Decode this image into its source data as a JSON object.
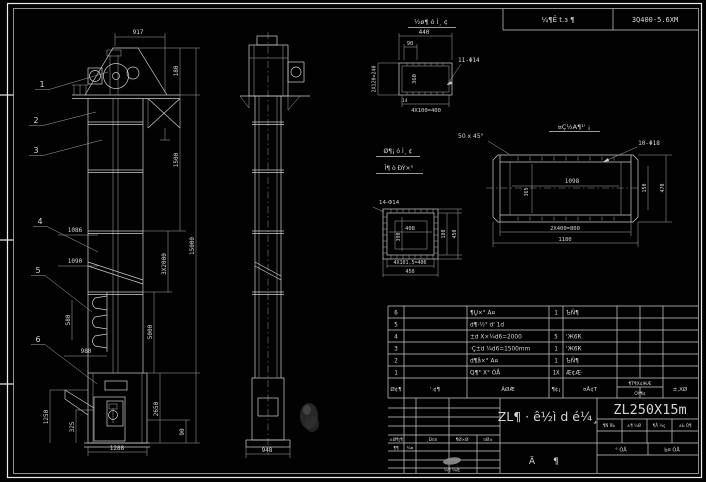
{
  "drawing": {
    "header": {
      "stamp": "¼¶Ê t.з ¶",
      "code": "3Q400-5.6XM"
    },
    "front": {
      "balloons": [
        "1",
        "2",
        "3",
        "4",
        "5",
        "6"
      ],
      "dim_917": "917",
      "dim_1086": "1086",
      "dim_1090": "1090",
      "dim_580": "580",
      "dim_980": "980",
      "dim_1250": "1250",
      "dim_325": "325",
      "dim_1288": "1288",
      "dim_180": "180",
      "dim_1500": "1500",
      "dim_15000": "15000",
      "dim_3x2000": "3X2000",
      "dim_5000": "5000",
      "dim_2650": "2650",
      "dim_90": "90"
    },
    "side": {
      "dim_948": "948"
    },
    "detail_top": {
      "label": "½ø¶ ó Ì¸ ¢",
      "dim_440": "440",
      "dim_90": "90",
      "dim_left": "2X120=240",
      "dim_inner": "360",
      "dim_bottom": "4X100=400",
      "holes": "11-Φ14",
      "dim_14": "14"
    },
    "detail_beam": {
      "label": "¤Ç½A¶¹' ¡",
      "chamfer": "50 x 45°",
      "holes": "10-Φ18",
      "dim_1098": "1098",
      "dim_365": "365",
      "dim_150": "150",
      "dim_470": "470",
      "dim_800": "2X400=800",
      "dim_1180": "1180"
    },
    "detail_square": {
      "label_1": "Ø¶¡ ó Ì¸ ¢",
      "label_2": "Î¶ ò ÐÝ×°",
      "holes": "14-Φ14",
      "dim_408": "408",
      "dim_390": "390",
      "dim_180": "180",
      "dim_450a": "450",
      "dim_406": "4X101.5=406",
      "dim_450b": "450"
    },
    "table": {
      "headers": {
        "no": "Ø¢¶",
        "code": "' ¢¶",
        "name": "ÃØÆ",
        "qty": "¶¢¡",
        "material": "¤Å¢Т",
        "weight": "¶Т¶X¢ЖÆ",
        "weight2": "ÓÝ¶¢",
        "remark": "±,XØ"
      },
      "rows": [
        {
          "no": "6",
          "name": "¶Ų×° A¤",
          "qty": "1",
          "material": "ЪÑ¶"
        },
        {
          "no": "5",
          "name": "d¶·½° d' 1d",
          "qty": "",
          "material": ""
        },
        {
          "no": "4",
          "name": "±d X×¼d6=2000",
          "qty": "5",
          "material": "'Ж6Ҟ"
        },
        {
          "no": "3",
          "name": "·Ç±d ¼d6=1500mm",
          "qty": "1",
          "material": "'Ж6Ҟ"
        },
        {
          "no": "2",
          "name": "d¶å×° A¤",
          "qty": "1",
          "material": "ЪÑ¶"
        },
        {
          "no": "1",
          "name": "Q¶° X° ÓÅ",
          "qty": "1X",
          "material": "Æ¢Æ·"
        }
      ]
    },
    "title_block": {
      "title": "ZL¶ · ê½ì d é¼¸",
      "model": "ZL250X15m",
      "stamp_a": "Ä",
      "stamp_b": "¶",
      "rev": {
        "h1": "±Ø¶¦¶",
        "h2": "¸Ð¤¤",
        "h3": "¶Ø×Ø",
        "h4": "¤Ø±",
        "r1": "¶¶",
        "r2": "¼¤",
        "bottom": "¼¶ ¼Æ"
      },
      "cells": [
        "¶Ñ ЯЬ",
        "±¶ ¼Ø",
        "¶Å ¼ç",
        "±Ь Ò¶"
      ],
      "sig1": "° ÓÅ",
      "sig2": "Ь¤ ÓÅ"
    }
  }
}
